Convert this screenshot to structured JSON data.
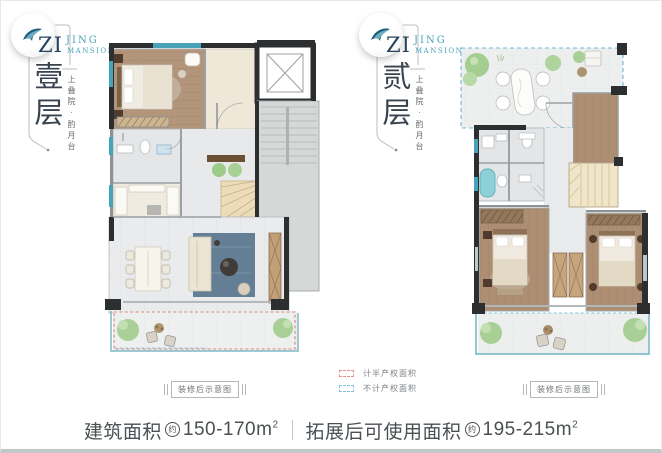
{
  "brand": {
    "zi": "ZI",
    "jing": "JING",
    "mansion": "MANSION",
    "tagline": "上叠院·酌月台"
  },
  "panels": {
    "floor1": {
      "label": "壹层",
      "caption": "装修后示意图"
    },
    "floor2": {
      "label": "贰层",
      "caption": "装修后示意图"
    }
  },
  "legend": {
    "half_property": {
      "label": "计半产权面积",
      "color": "#e59090"
    },
    "no_property": {
      "label": "不计产权面积",
      "color": "#85c3dc"
    }
  },
  "footer": {
    "built_area_label": "建筑面积",
    "approx": "约",
    "built_area_value": "150-170m",
    "sup": "2",
    "usable_area_label": "拓展后可使用面积",
    "usable_area_value": "195-215m"
  },
  "colors": {
    "teal_accent": "#47a4b8",
    "navy": "#24425e",
    "wall_dark": "#2d2e30",
    "wood_floor": "#b2957a",
    "tile_light": "#e9ebec",
    "terrace": "#eef0f0",
    "plant_green": "#a8d096",
    "half_property_dash": "#e59090",
    "no_property_dash": "#85c3dc"
  }
}
